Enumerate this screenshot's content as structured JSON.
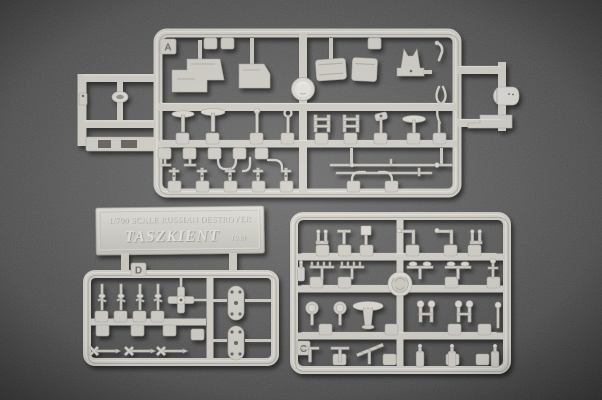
{
  "scene": {
    "description": "Photograph of light gray injection-molded plastic model kit sprues (parts trees) laid on dark gray felt",
    "sprue_count": 3,
    "has_nameplate_part": true
  },
  "colors": {
    "background_center": "#6f6f6f",
    "background_edge": "#3a3a3a",
    "plastic": "#d4d2cb",
    "plastic_highlight": "#edebe5",
    "plastic_shadow": "#9b9992"
  },
  "nameplate": {
    "scale_line": "1/700 SCALE RUSSIAN DESTROYER",
    "ship_name": "TASZKIENT",
    "year": "1940"
  },
  "sprues": {
    "a": {
      "label": "A",
      "position": "top"
    },
    "c": {
      "label": "C",
      "position": "bottom-right"
    },
    "d": {
      "label": "D",
      "position": "bottom-left"
    }
  }
}
